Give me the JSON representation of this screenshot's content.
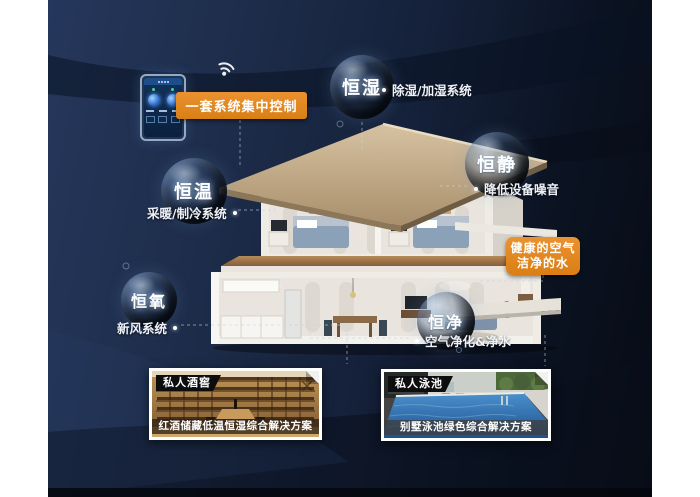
{
  "control": {
    "label": "一套系统集中控制",
    "wifi_icon": "wifi-icon",
    "phone_icon": "smart-home-control-phone"
  },
  "bubbles": [
    {
      "label": "恒湿",
      "feature": "除湿/加湿系统"
    },
    {
      "label": "恒静",
      "feature": "降低设备噪音"
    },
    {
      "label": "恒温",
      "feature": "采暖/制冷系统"
    },
    {
      "label": "恒氧",
      "feature": "新风系统"
    },
    {
      "label": "恒净",
      "feature": "空气净化&净水"
    }
  ],
  "highlight_box": {
    "line1": "健康的空气",
    "line2": "洁净的水"
  },
  "photos": [
    {
      "badge": "私人酒窖",
      "caption": "红酒储藏低温恒湿综合解决方案"
    },
    {
      "badge": "私人泳池",
      "caption": "别墅泳池绿色综合解决方案"
    }
  ],
  "colors": {
    "accent_orange": "#e0861f",
    "background_navy": "#1d2c49",
    "background_dark": "#070b14",
    "label_text": "#eef2f8",
    "pool_blue": "#2f6fae",
    "wood_brown": "#a87c46"
  }
}
